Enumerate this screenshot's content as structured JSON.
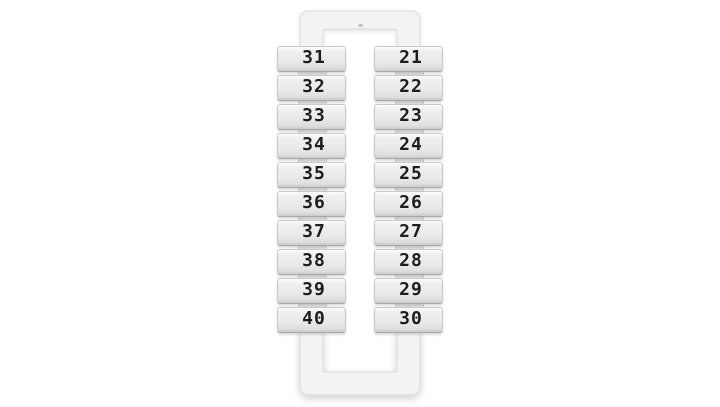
{
  "product": {
    "item": "terminal-marker-strip",
    "left_column_numbers": [
      "31",
      "32",
      "33",
      "34",
      "35",
      "36",
      "37",
      "38",
      "39",
      "40"
    ],
    "right_column_numbers": [
      "21",
      "22",
      "23",
      "24",
      "25",
      "26",
      "27",
      "28",
      "29",
      "30"
    ]
  },
  "colors": {
    "background": "#ffffff",
    "plastic_frame": "#f3f3f3",
    "tab_face": "#ebebeb",
    "tab_edge": "#a9a9a9",
    "digit_ink": "#1d1d1d"
  }
}
